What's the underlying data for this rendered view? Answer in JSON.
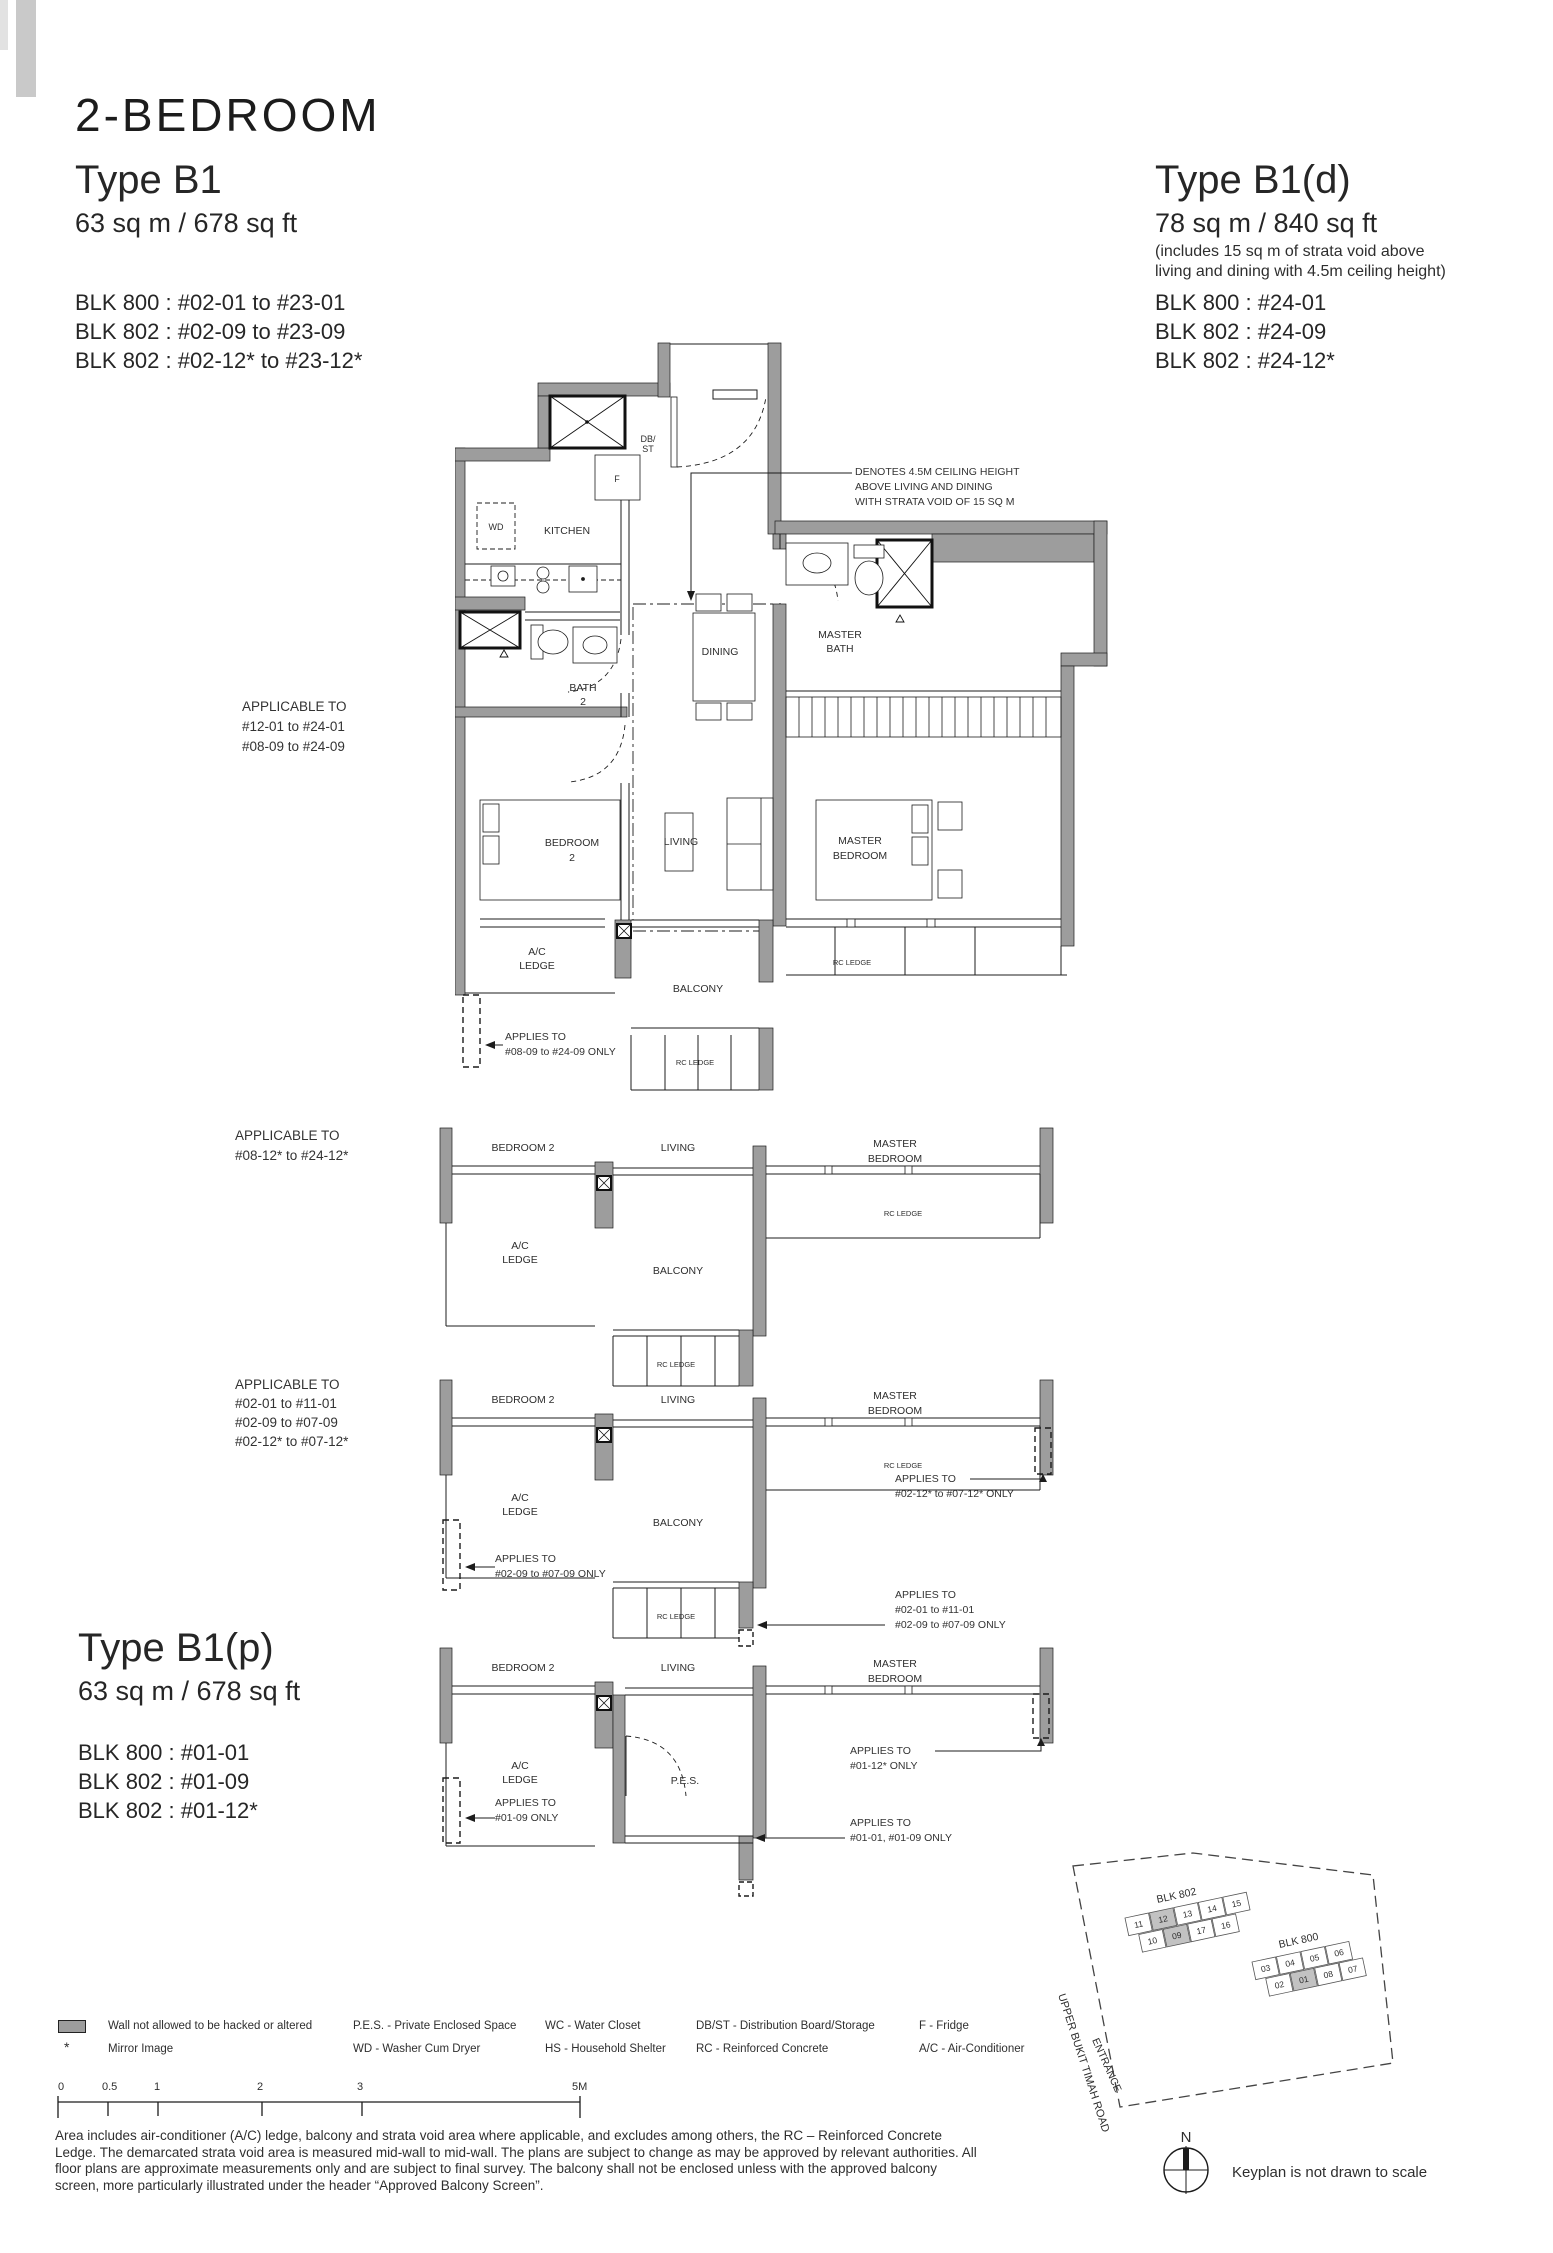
{
  "header": {
    "title": "2-BEDROOM",
    "b1": {
      "name": "Type B1",
      "area": "63 sq m / 678 sq ft",
      "blocks": [
        "BLK 800 : #02-01 to #23-01",
        "BLK 802 : #02-09 to #23-09",
        "BLK 802 : #02-12* to #23-12*"
      ]
    },
    "b1d": {
      "name": "Type B1(d)",
      "area": "78 sq m / 840 sq ft",
      "note": [
        "(includes 15 sq m of strata void above",
        "living and dining with 4.5m ceiling height)"
      ],
      "blocks": [
        "BLK 800 : #24-01",
        "BLK 802 : #24-09",
        "BLK 802 : #24-12*"
      ]
    },
    "b1p": {
      "name": "Type B1(p)",
      "area": "63 sq m / 678 sq ft",
      "blocks": [
        "BLK 800 : #01-01",
        "BLK 802 : #01-09",
        "BLK 802 : #01-12*"
      ]
    }
  },
  "rooms": {
    "kitchen": "KITCHEN",
    "dining": "DINING",
    "living": "LIVING",
    "balcony": "BALCONY",
    "pes": "P.E.S.",
    "bedroom2": "BEDROOM 2",
    "bedroom2_l1": "BEDROOM",
    "bedroom2_l2": "2",
    "master_l1": "MASTER",
    "master_l2": "BEDROOM",
    "mbath_l1": "MASTER",
    "mbath_l2": "BATH",
    "bath2_l1": "BATH",
    "bath2_l2": "2",
    "ac_l1": "A/C",
    "ac_l2": "LEDGE",
    "rc": "RC LEDGE",
    "wd": "WD",
    "f": "F",
    "db1": "DB/",
    "db2": "ST"
  },
  "ann": {
    "denotes": [
      "DENOTES 4.5M CEILING HEIGHT",
      "ABOVE LIVING AND DINING",
      "WITH STRATA VOID OF 15 SQ M"
    ],
    "app1": [
      "APPLICABLE TO",
      "#12-01 to #24-01",
      "#08-09 to #24-09"
    ],
    "app1_note": [
      "APPLIES TO",
      "#08-09 to #24-09 ONLY"
    ],
    "app2": [
      "APPLICABLE TO",
      "#08-12* to #24-12*"
    ],
    "app3": [
      "APPLICABLE TO",
      "#02-01 to #11-01",
      "#02-09 to #07-09",
      "#02-12* to #07-12*"
    ],
    "app3_left": [
      "APPLIES TO",
      "#02-09 to #07-09 ONLY"
    ],
    "app3_r1": [
      "APPLIES TO",
      "#02-12* to #07-12* ONLY"
    ],
    "app3_r2": [
      "APPLIES TO",
      "#02-01 to #11-01",
      "#02-09 to #07-09 ONLY"
    ],
    "app4_left": [
      "APPLIES TO",
      "#01-09 ONLY"
    ],
    "app4_r1": [
      "APPLIES TO",
      "#01-12* ONLY"
    ],
    "app4_r2": [
      "APPLIES TO",
      "#01-01, #01-09 ONLY"
    ]
  },
  "legend": {
    "wall": "Wall not allowed to be hacked or altered",
    "mirror_mark": "*",
    "mirror": "Mirror Image",
    "col2": [
      "P.E.S. - Private Enclosed Space",
      "WD - Washer Cum Dryer"
    ],
    "col3": [
      "WC - Water Closet",
      "HS - Household Shelter"
    ],
    "col4": [
      "DB/ST - Distribution Board/Storage",
      "RC - Reinforced Concrete"
    ],
    "col5": [
      "F - Fridge",
      "A/C - Air-Conditioner"
    ]
  },
  "scale": {
    "labels": [
      "0",
      "0.5",
      "1",
      "2",
      "3",
      "5M"
    ]
  },
  "disclaimer": [
    "Area includes air-conditioner (A/C) ledge, balcony and strata void area where applicable, and excludes among others, the RC – Reinforced Concrete",
    "Ledge. The demarcated strata void area is measured mid-wall to mid-wall. The plans are subject to change as may be approved by relevant authorities. All",
    "floor plans are approximate measurements only and are subject to final survey. The balcony shall not be enclosed unless with the approved balcony",
    "screen, more particularly illustrated under the header “Approved Balcony Screen”."
  ],
  "keyplan": {
    "road": "UPPER BUKIT TIMAH ROAD",
    "entrance": "ENTRANCE",
    "blk802": "BLK 802",
    "blk800": "BLK 800",
    "b802r1": [
      "11",
      "12",
      "13",
      "14",
      "15"
    ],
    "b802r2": [
      "10",
      "09",
      "17",
      "16"
    ],
    "b800r1": [
      "03",
      "04",
      "05",
      "06"
    ],
    "b800r2": [
      "02",
      "01",
      "08",
      "07"
    ],
    "north": "N",
    "note": "Keyplan is not drawn to scale"
  },
  "colors": {
    "wall": "#9d9d9d",
    "highlight": "#c2c2c2",
    "line": "#1c1c1c"
  }
}
